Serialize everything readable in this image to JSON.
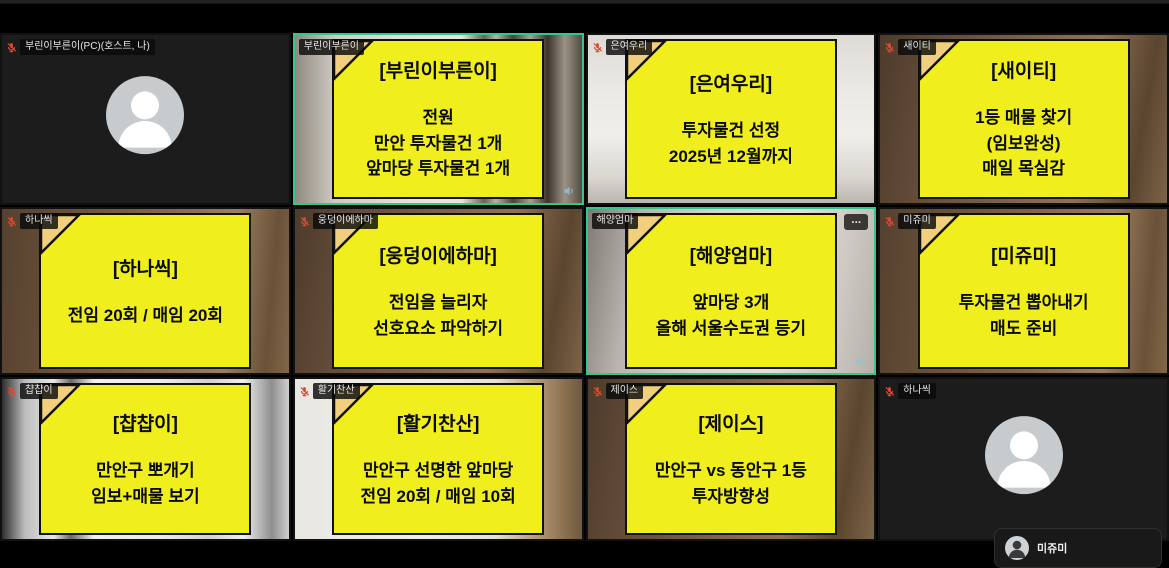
{
  "meeting": {
    "tiles": [
      {
        "label": "부린이부른이(PC)(호스트, 나)",
        "muted": true,
        "kind": "avatar"
      },
      {
        "label": "부린이부른이",
        "muted": false,
        "active": true,
        "kind": "video",
        "note": {
          "title": "[부린이부른이]",
          "body": "전원\n만안 투자물건 1개\n앞마당 투자물건 1개"
        }
      },
      {
        "label": "은여우리",
        "muted": true,
        "kind": "video",
        "note": {
          "title": "[은여우리]",
          "body": "투자물건 선정\n2025년 12월까지"
        }
      },
      {
        "label": "새이티",
        "muted": true,
        "kind": "video",
        "note": {
          "title": "[새이티]",
          "body": "1등 매물 찾기\n(임보완성)\n매일 목실감"
        }
      },
      {
        "label": "하나씩",
        "muted": true,
        "kind": "video",
        "note": {
          "title": "[하나씩]",
          "body": "전임 20회 / 매임 20회"
        }
      },
      {
        "label": "웅덩이에하마",
        "muted": true,
        "kind": "video",
        "note": {
          "title": "[웅덩이에하마]",
          "body": "전임을 늘리자\n선호요소 파악하기"
        }
      },
      {
        "label": "해양엄마",
        "muted": false,
        "active": true,
        "kind": "video",
        "more_button": "...",
        "note": {
          "title": "[해양엄마]",
          "body": "앞마당 3개\n올해 서울수도권 등기"
        }
      },
      {
        "label": "미쥬미",
        "muted": true,
        "kind": "video",
        "note": {
          "title": "[미쥬미]",
          "body": "투자물건 뽑아내기\n매도 준비"
        }
      },
      {
        "label": "챱챱이",
        "muted": true,
        "kind": "video",
        "note": {
          "title": "[챱챱이]",
          "body": "만안구 뽀개기\n임보+매물 보기"
        }
      },
      {
        "label": "활기찬산",
        "muted": true,
        "kind": "video",
        "note": {
          "title": "[활기찬산]",
          "body": "만안구 선명한 앞마당\n전임 20회 / 매임 10회"
        }
      },
      {
        "label": "제이스",
        "muted": true,
        "kind": "video",
        "note": {
          "title": "[제이스]",
          "body": "만안구 vs 동안구 1등\n투자방향성"
        }
      },
      {
        "label": "하나씩",
        "muted": true,
        "kind": "avatar"
      }
    ],
    "overlay": {
      "name": "미쥬미"
    },
    "colors": {
      "note_bg": "#f1ee1e",
      "note_fold": "#f2cf7d",
      "active_border": "#2fc98e",
      "muted_mic": "#e0492f"
    }
  }
}
